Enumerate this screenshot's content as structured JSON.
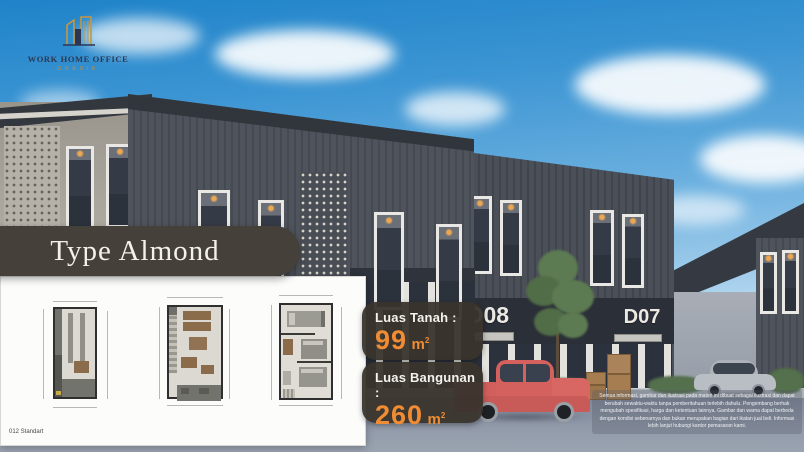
{
  "logo": {
    "title": "WORK HOME OFFICE",
    "subtitle": "GRESIK"
  },
  "card": {
    "title": "Type Almond",
    "footnote": "012 Standart"
  },
  "specs": {
    "land_label": "Luas Tanah :",
    "land_value": "99",
    "land_unit": "m",
    "land_unit_sup": "2",
    "building_label": "Luas Bangunan :",
    "building_value": "260",
    "building_unit": "m",
    "building_unit_sup": "2"
  },
  "scene": {
    "unit_d08": "D08",
    "unit_d07": "D07"
  },
  "disclaimer": "Semua informasi, gambar dan ilustrasi pada materi ini dibuat sebagai ilustrasi dan dapat berubah sewaktu-waktu tanpa pemberitahuan terlebih dahulu. Pengembang berhak mengubah spesifikasi, harga dan ketentuan lainnya. Gambar dan warna dapat berbeda dengan kondisi sebenarnya dan bukan merupakan bagian dari ikatan jual beli. Informasi lebih lanjut hubungi kantor pemasaran kami.",
  "colors": {
    "accent_orange": "#f08c33",
    "badge_bg": "#39342c",
    "pill_bg": "#45403a",
    "logo_gold": "#c5973f",
    "logo_navy": "#2d3752"
  }
}
